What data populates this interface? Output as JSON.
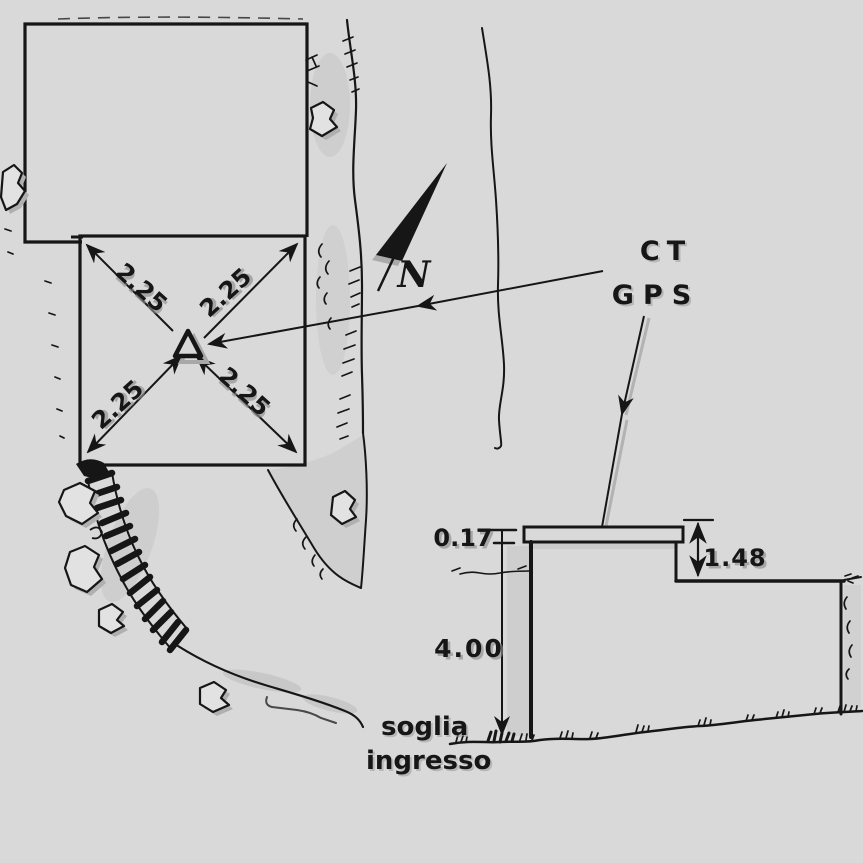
{
  "palette": {
    "paper": "#d9d9d9",
    "ink": "#161616",
    "shade": "#a8a8a8"
  },
  "plan": {
    "north_label": "N",
    "station": {
      "ct_label": "CT",
      "gps_label": "GPS"
    },
    "diagonal_dimensions": [
      "2.25",
      "2.25",
      "2.25",
      "2.25"
    ]
  },
  "section": {
    "slab_thickness": "0.17",
    "height_above_threshold": "4.00",
    "roof_step_height": "1.48",
    "threshold_caption_line1": "soglia",
    "threshold_caption_line2": "ingresso"
  }
}
